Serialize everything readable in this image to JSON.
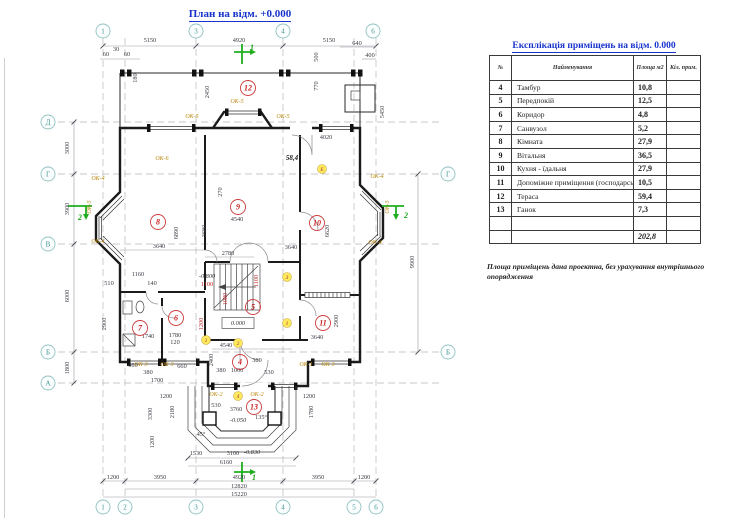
{
  "page": {
    "title": "План на відм. +0.000"
  },
  "table": {
    "title": "Експлікація приміщень на відм.  0.000",
    "headers": [
      "№",
      "Найменування",
      "Площа м2",
      "Кіл. прим."
    ],
    "rows": [
      {
        "num": "4",
        "name": "Тамбур",
        "area": "10,8",
        "cnt": ""
      },
      {
        "num": "5",
        "name": "Передпокій",
        "area": "12,5",
        "cnt": ""
      },
      {
        "num": "6",
        "name": "Коридор",
        "area": "4,8",
        "cnt": ""
      },
      {
        "num": "7",
        "name": "Санвузол",
        "area": "5,2",
        "cnt": ""
      },
      {
        "num": "8",
        "name": "Кімната",
        "area": "27,9",
        "cnt": ""
      },
      {
        "num": "9",
        "name": "Вітальня",
        "area": "36,5",
        "cnt": ""
      },
      {
        "num": "10",
        "name": "Кухня - їдальня",
        "area": "27,9",
        "cnt": ""
      },
      {
        "num": "11",
        "name": "Допоміжне приміщення (господарське)",
        "area": "10,5",
        "cnt": ""
      },
      {
        "num": "12",
        "name": "Тераса",
        "area": "59,4",
        "cnt": ""
      },
      {
        "num": "13",
        "name": "Ганок",
        "area": "7,3",
        "cnt": ""
      },
      {
        "num": "",
        "name": "",
        "area": "",
        "cnt": ""
      }
    ],
    "total": "202,8",
    "note": "Площа приміщень дана проектна, без урахування внутрішнього опорядження"
  },
  "plan": {
    "labels": [
      [
        "5150",
        150,
        42
      ],
      [
        "4920",
        239,
        42
      ],
      [
        "5150",
        329,
        42
      ],
      [
        "60",
        106,
        56
      ],
      [
        "30",
        116,
        51
      ],
      [
        "60",
        127,
        56
      ],
      [
        "180",
        137,
        78,
        "d",
        -90
      ],
      [
        "640",
        357,
        45
      ],
      [
        "400",
        370,
        57
      ],
      [
        "500",
        318,
        57,
        "d",
        -90
      ],
      [
        "770",
        318,
        86,
        "d",
        -90
      ],
      [
        "2450",
        209,
        92,
        "d",
        -90
      ],
      [
        "5450",
        384,
        112,
        "d",
        -90
      ],
      [
        "4020",
        326,
        139
      ],
      [
        "58,4",
        292,
        160,
        "db"
      ],
      [
        "3000",
        69,
        148,
        "d",
        -90
      ],
      [
        "3900",
        69,
        209,
        "d",
        -90
      ],
      [
        "6000",
        69,
        296,
        "d",
        -90
      ],
      [
        "1800",
        69,
        368,
        "d",
        -90
      ],
      [
        "9900",
        414,
        262,
        "d",
        -90
      ],
      [
        "1200",
        113,
        479
      ],
      [
        "3950",
        160,
        479
      ],
      [
        "4920",
        239,
        479
      ],
      [
        "3950",
        318,
        479
      ],
      [
        "1200",
        364,
        479
      ],
      [
        "12820",
        239,
        488
      ],
      [
        "15220",
        239,
        496
      ],
      [
        "3640",
        159,
        248
      ],
      [
        "6890",
        178,
        233,
        "d",
        -90
      ],
      [
        "270",
        222,
        192,
        "d",
        -90
      ],
      [
        "4540",
        237,
        221
      ],
      [
        "3680",
        206,
        231,
        "d",
        -90
      ],
      [
        "2780",
        228,
        255
      ],
      [
        "510",
        109,
        285
      ],
      [
        "140",
        152,
        285
      ],
      [
        "1160",
        138,
        276
      ],
      [
        "2900",
        106,
        324,
        "d",
        -90
      ],
      [
        "1740",
        148,
        338
      ],
      [
        "1780",
        175,
        337
      ],
      [
        "120",
        175,
        344
      ],
      [
        "660",
        133,
        367
      ],
      [
        "380",
        148,
        374
      ],
      [
        "1700",
        157,
        382
      ],
      [
        "660",
        182,
        368
      ],
      [
        "-0.800",
        207,
        278,
        "lv"
      ],
      [
        "1100",
        207,
        286,
        "dr"
      ],
      [
        "1100",
        258,
        281,
        "dr",
        -90
      ],
      [
        "1080",
        227,
        299,
        "dr",
        -90
      ],
      [
        "1200",
        203,
        324,
        "dr",
        -90
      ],
      [
        "4540",
        226,
        347
      ],
      [
        "2400",
        213,
        360,
        "d",
        -90
      ],
      [
        "380",
        221,
        372
      ],
      [
        "1000",
        237,
        372
      ],
      [
        "380",
        257,
        362
      ],
      [
        "530",
        269,
        374
      ],
      [
        "3640",
        291,
        249
      ],
      [
        "6620",
        329,
        231,
        "d",
        -90
      ],
      [
        "2900",
        338,
        321,
        "d",
        -90
      ],
      [
        "3640",
        317,
        339
      ],
      [
        "1200",
        166,
        398
      ],
      [
        "2180",
        174,
        412,
        "d",
        -90
      ],
      [
        "3300",
        152,
        414,
        "d",
        -90
      ],
      [
        "530",
        216,
        407
      ],
      [
        "3760",
        236,
        411
      ],
      [
        "-0.050",
        238,
        422,
        "lv"
      ],
      [
        "1200",
        309,
        398
      ],
      [
        "1780",
        313,
        412,
        "d",
        -90
      ],
      [
        "1200",
        154,
        442,
        "d",
        -90
      ],
      [
        "45°",
        201,
        436
      ],
      [
        "135°",
        261,
        419
      ],
      [
        "1530",
        196,
        455
      ],
      [
        "3100",
        233,
        455
      ],
      [
        "-0.830",
        252,
        454,
        "lv"
      ],
      [
        "6160",
        226,
        464
      ],
      [
        "0.000",
        238,
        325,
        "lv"
      ],
      [
        "ОК-5",
        192,
        118,
        "ok"
      ],
      [
        "ОК-5",
        237,
        103,
        "ok"
      ],
      [
        "ОК-5",
        283,
        118,
        "ok"
      ],
      [
        "ОК-5",
        91,
        207,
        "ok",
        -90
      ],
      [
        "ОК-5",
        389,
        207,
        "ok",
        -90
      ],
      [
        "ОК-6",
        162,
        160,
        "ok"
      ],
      [
        "ОК-4",
        98,
        180,
        "ok"
      ],
      [
        "ОК-4",
        98,
        243,
        "ok"
      ],
      [
        "ОК-4",
        377,
        178,
        "ok"
      ],
      [
        "ОК-4",
        375,
        244,
        "ok"
      ],
      [
        "ОК-3",
        141,
        366,
        "ok"
      ],
      [
        "ОК-3",
        167,
        366,
        "ok"
      ],
      [
        "ОК-1",
        306,
        366,
        "ok"
      ],
      [
        "ОК-3",
        328,
        366,
        "ok"
      ],
      [
        "ОК-2",
        216,
        396,
        "ok"
      ],
      [
        "ОК-2",
        257,
        396,
        "ok"
      ],
      [
        "1",
        252,
        50,
        "gr"
      ],
      [
        "1",
        254,
        480,
        "gr"
      ],
      [
        "2",
        80,
        220,
        "gr"
      ],
      [
        "2",
        406,
        218,
        "gr"
      ]
    ],
    "bubbles": [
      [
        "1",
        103,
        31,
        "g"
      ],
      [
        "3",
        196,
        31,
        "g"
      ],
      [
        "4",
        283,
        31,
        "g"
      ],
      [
        "6",
        373,
        31,
        "g"
      ],
      [
        "1",
        103,
        507,
        "g"
      ],
      [
        "2",
        125,
        507,
        "g"
      ],
      [
        "3",
        196,
        507,
        "g"
      ],
      [
        "4",
        283,
        507,
        "g"
      ],
      [
        "5",
        354,
        507,
        "g"
      ],
      [
        "6",
        376,
        507,
        "g"
      ],
      [
        "Д",
        48,
        122,
        "g"
      ],
      [
        "Г",
        48,
        174,
        "g"
      ],
      [
        "В",
        48,
        244,
        "g"
      ],
      [
        "Б",
        48,
        352,
        "g"
      ],
      [
        "А",
        48,
        383,
        "g"
      ],
      [
        "Г",
        448,
        174,
        "g"
      ],
      [
        "Б",
        448,
        352,
        "g"
      ],
      [
        "12",
        248,
        88,
        "r"
      ],
      [
        "8",
        158,
        222,
        "r"
      ],
      [
        "9",
        238,
        207,
        "r"
      ],
      [
        "10",
        317,
        223,
        "r"
      ],
      [
        "7",
        140,
        328,
        "r"
      ],
      [
        "6",
        176,
        318,
        "r"
      ],
      [
        "5",
        253,
        307,
        "r"
      ],
      [
        "4",
        240,
        362,
        "r"
      ],
      [
        "11",
        323,
        323,
        "r"
      ],
      [
        "13",
        254,
        407,
        "r"
      ],
      [
        "Е",
        322,
        169,
        "t"
      ],
      [
        "3",
        287,
        277,
        "t"
      ],
      [
        "1",
        287,
        323,
        "t"
      ],
      [
        "2",
        238,
        343,
        "t"
      ],
      [
        "1",
        206,
        340,
        "t"
      ],
      [
        "4",
        238,
        396,
        "t"
      ]
    ],
    "colors": {
      "title_blue": "#1733cc",
      "room_red": "#cc2222",
      "window_tag": "#b8860b",
      "section_green": "#1fae1f",
      "grid_teal": "#3f8f8f"
    }
  }
}
